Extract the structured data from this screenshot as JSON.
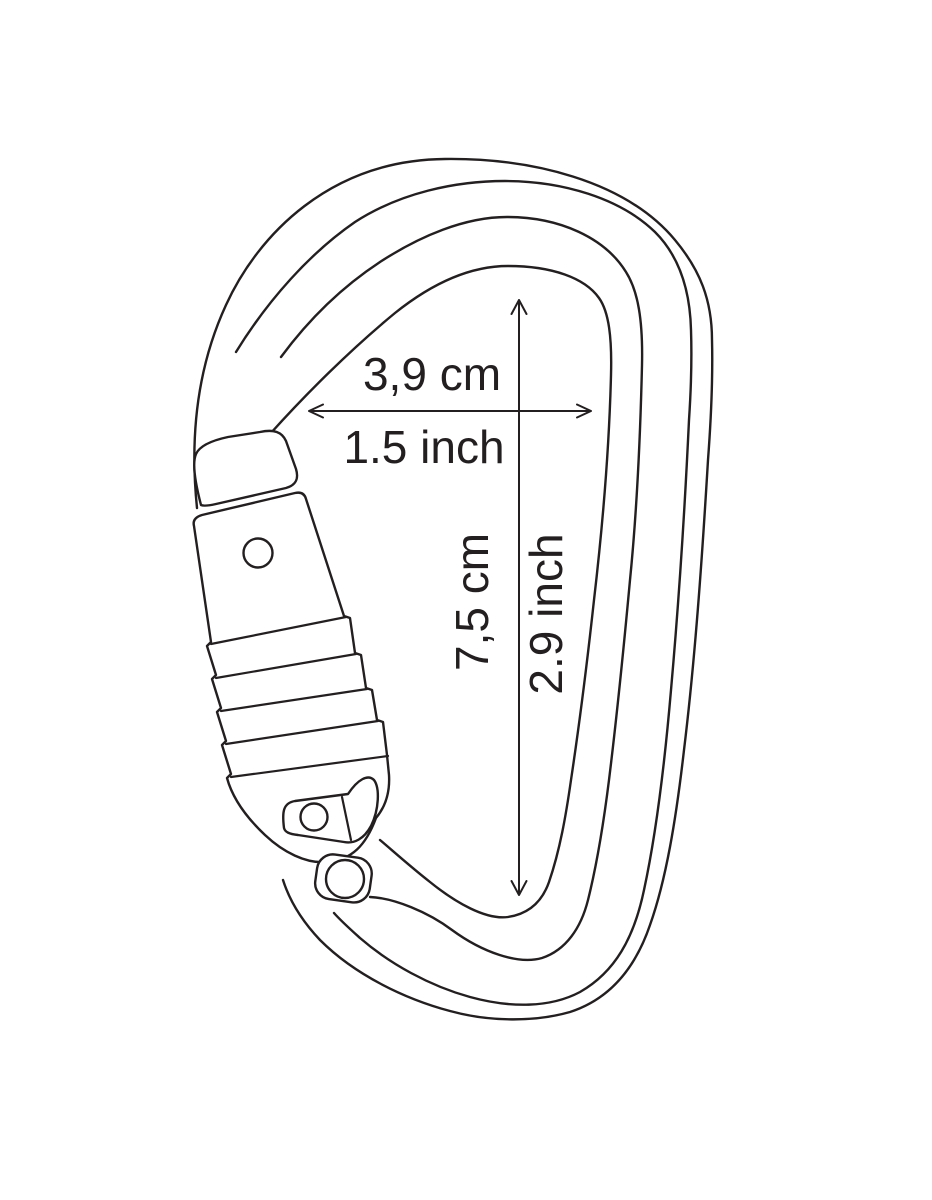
{
  "page": {
    "background": "#ffffff",
    "title": "Carabiner technical drawing with dimensions"
  },
  "diagram": {
    "subject": "locking-carabiner-line-drawing",
    "line_color": "#231f20",
    "dimensions": {
      "width": {
        "metric": "3,9 cm",
        "imperial": "1.5 inch"
      },
      "height": {
        "metric": "7,5 cm",
        "imperial": "2.9 inch"
      }
    }
  }
}
